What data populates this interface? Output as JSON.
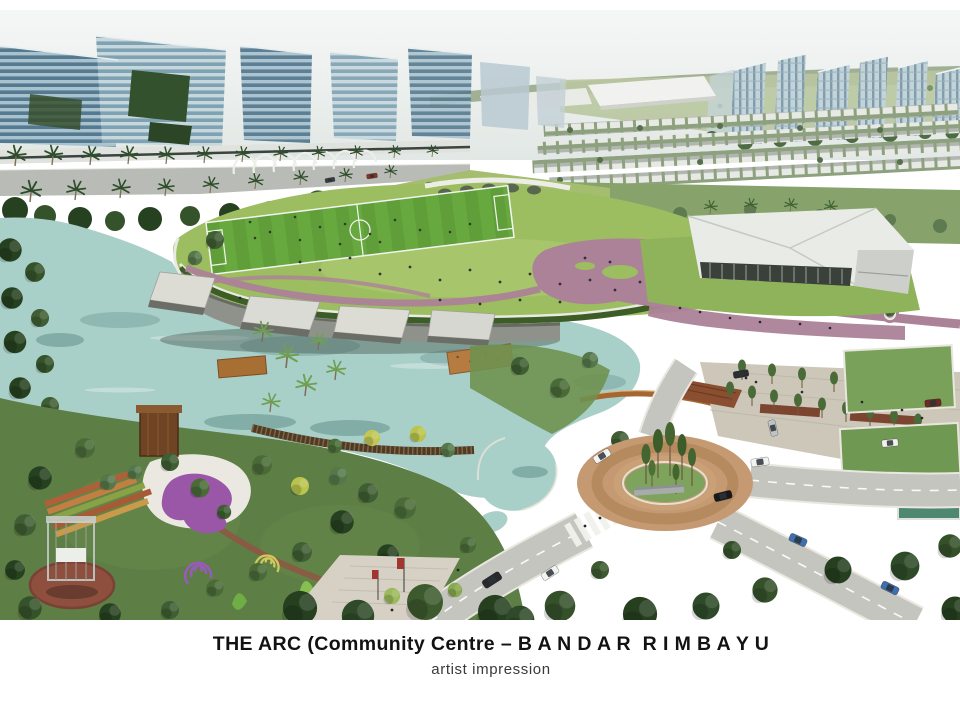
{
  "figure": {
    "alt": "Aerial artist impression: elevated oval park with football field above a lakeside community centre, gardens, boardwalks, roundabout roads and city towers"
  },
  "caption": {
    "title": "THE ARC (Community Centre – B A N D A R  R I M B A Y U",
    "subtitle": "artist impression"
  },
  "palette": {
    "page-bg": "#ffffff",
    "sky": "#eef1ef",
    "horizon-green": "#93a584",
    "glass-light": "#a9c2cf",
    "glass-dark": "#5b7f94",
    "tower-pale": "#c3d3da",
    "lawn": "#9cbd60",
    "pitch-green": "#63a43c",
    "path-pink": "#ac8298",
    "hedge": "#3c5d26",
    "lake": "#a9cfc9",
    "wood": "#a5662f",
    "grass-dark": "#5d7f45",
    "flower-purple": "#9a57a8",
    "brick": "#8e4f3f",
    "road": "#c4c5bf",
    "sidewalk": "#cdc7b9",
    "roundabout-brick": "#c59a73",
    "island-green": "#7da35c",
    "car-white": "#f2f2f0",
    "car-black": "#17191b",
    "car-blue": "#3f6fae",
    "caption-color": "#121212",
    "subtitle-color": "#3a3a3a"
  }
}
